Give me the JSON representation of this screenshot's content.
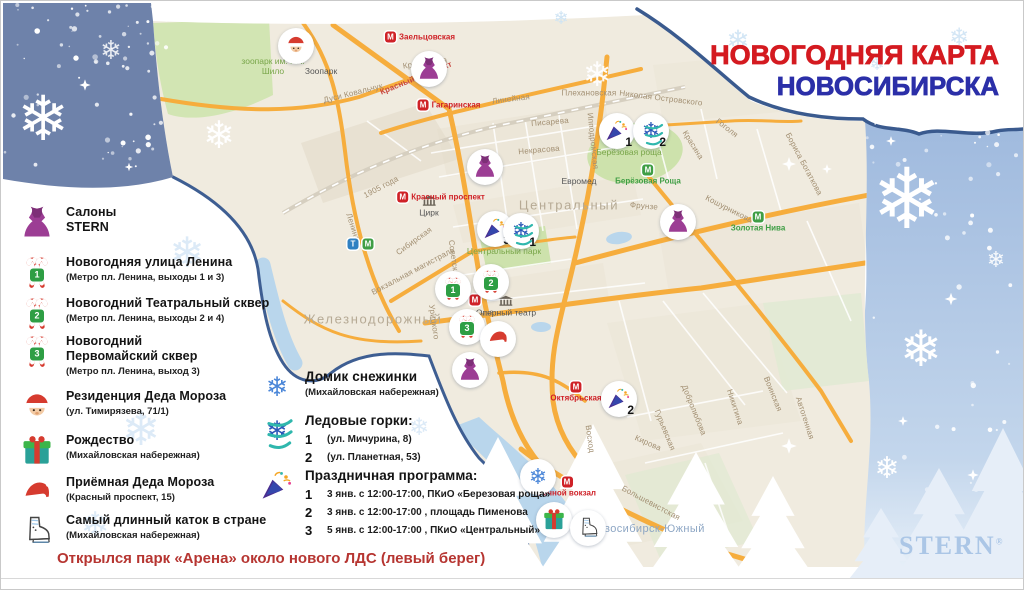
{
  "title": {
    "line1": "НОВОГОДНЯЯ КАРТА",
    "line2": "НОВОСИБИРСКА"
  },
  "brand": {
    "name": "STERN",
    "reg": "®"
  },
  "note": "Открылся парк «Арена» около нового ЛДС (левый берег)",
  "colors": {
    "title_red": "#d41a20",
    "title_blue": "#2b2fa8",
    "note_red": "#b63531",
    "brand_blue": "#abc6e6",
    "road_orange": "#f6ad3d",
    "water_blue": "#b9d6ec",
    "park_green": "#cde2ac",
    "panel_blue": "#9db8dd",
    "corner_slate": "#6e82aa",
    "boundary_navy": "#3e5e92",
    "metro_red": "#cf2127",
    "metro_green": "#3f9e45"
  },
  "legend": [
    {
      "icon": "dress-icon",
      "y": 204,
      "title": "Салоны\nSTERN"
    },
    {
      "icon": "candy-icon",
      "num": "1",
      "y": 254,
      "title": "Новогодняя улица Ленина",
      "sub": "(Метро пл. Ленина, выходы 1 и 3)"
    },
    {
      "icon": "candy-icon",
      "num": "2",
      "y": 295,
      "title": "Новогодний Театральный сквер",
      "sub": "(Метро пл. Ленина, выходы 2 и 4)"
    },
    {
      "icon": "candy-icon",
      "num": "3",
      "y": 333,
      "title": "Новогодний\nПервомайский сквер",
      "sub": "(Метро пл. Ленина, выход 3)"
    },
    {
      "icon": "santa-icon",
      "y": 388,
      "title": "Резиденция Деда Мороза",
      "sub": "(ул. Тимирязева, 71/1)"
    },
    {
      "icon": "gift-icon",
      "y": 432,
      "title": "Рождество",
      "sub": "(Михайловская набережная)"
    },
    {
      "icon": "hat-icon",
      "y": 474,
      "title": "Приёмная Деда Мороза",
      "sub": "(Красный проспект, 15)"
    },
    {
      "icon": "skate-icon",
      "y": 512,
      "title": "Самый длинный каток в стране",
      "sub": "(Михайловская набережная)"
    }
  ],
  "legend_mid": {
    "snow_house": {
      "icon": "flake-icon",
      "title": "Домик снежинки",
      "sub": "(Михайловская набережная)"
    },
    "slides": {
      "icon": "slide-icon",
      "title": "Ледовые горки:",
      "rows": [
        {
          "num": "1",
          "text": "(ул. Мичурина, 8)"
        },
        {
          "num": "2",
          "text": "(ул. Планетная, 53)"
        }
      ]
    },
    "program": {
      "icon": "popper-icon",
      "title": "Праздничная программа:",
      "rows": [
        {
          "num": "1",
          "text": "3 янв. с 12:00-17:00, ПКиО «Березовая роща»"
        },
        {
          "num": "2",
          "text": "3 янв. с 12:00-17:00 , площадь Пименова"
        },
        {
          "num": "3",
          "text": "5 янв. с 12:00-17:00 , ПКиО «Центральный»"
        }
      ]
    }
  },
  "map": {
    "districts": [
      {
        "label": "Центральный",
        "x": 568,
        "y": 204
      },
      {
        "label": "Железнодорожный",
        "x": 372,
        "y": 318
      },
      {
        "label": "Новосибирск-Южный",
        "x": 646,
        "y": 528,
        "cls": "blue"
      }
    ],
    "greens": [
      {
        "label": "Берёзовая роща",
        "x": 628,
        "y": 152
      },
      {
        "label": "Центральный парк",
        "x": 503,
        "y": 251
      },
      {
        "label": "зоопарк им. Р.А.\nШило",
        "x": 272,
        "y": 66
      }
    ],
    "pois": [
      {
        "label": "Зоопарк",
        "x": 320,
        "y": 70
      },
      {
        "label": "Цирк",
        "icon": "building-icon",
        "x": 428,
        "y": 205
      },
      {
        "label": "Оперный театр",
        "icon": "building-icon",
        "x": 505,
        "y": 305
      },
      {
        "label": "Евромед",
        "x": 578,
        "y": 180
      }
    ],
    "streets": [
      {
        "label": "Дуси Ковальчук",
        "x": 352,
        "y": 92,
        "rot": -14
      },
      {
        "label": "Кропоткина",
        "x": 424,
        "y": 62,
        "rot": -8
      },
      {
        "label": "Красный проспект",
        "x": 415,
        "y": 77,
        "rot": -22,
        "cls": "red"
      },
      {
        "label": "Линейная",
        "x": 510,
        "y": 98,
        "rot": -7
      },
      {
        "label": "Плехановская",
        "x": 588,
        "y": 92,
        "rot": 0
      },
      {
        "label": "Николая Островского",
        "x": 660,
        "y": 97,
        "rot": 7
      },
      {
        "label": "Писарева",
        "x": 549,
        "y": 121,
        "rot": -5
      },
      {
        "label": "Некрасова",
        "x": 538,
        "y": 149,
        "rot": -5
      },
      {
        "label": "Гоголя",
        "x": 726,
        "y": 127,
        "rot": 38
      },
      {
        "label": "Красина",
        "x": 692,
        "y": 144,
        "rot": 58
      },
      {
        "label": "Фрунзе",
        "x": 643,
        "y": 205,
        "rot": 5
      },
      {
        "label": "Фрунзе",
        "x": 479,
        "y": 313,
        "rot": -8
      },
      {
        "label": "Кошурникова",
        "x": 728,
        "y": 208,
        "rot": 27
      },
      {
        "label": "Бориса Богаткова",
        "x": 803,
        "y": 163,
        "rot": 62
      },
      {
        "label": "Ипподромская",
        "x": 592,
        "y": 140,
        "rot": 84
      },
      {
        "label": "Сибирская",
        "x": 413,
        "y": 240,
        "rot": -36
      },
      {
        "label": "Ленина",
        "x": 352,
        "y": 226,
        "rot": 72
      },
      {
        "label": "1905 года",
        "x": 380,
        "y": 186,
        "rot": -28
      },
      {
        "label": "Вокзальная магистраль",
        "x": 412,
        "y": 270,
        "rot": -28
      },
      {
        "label": "Советская",
        "x": 453,
        "y": 259,
        "rot": 82
      },
      {
        "label": "Урицкого",
        "x": 433,
        "y": 321,
        "rot": 82
      },
      {
        "label": "Восход",
        "x": 589,
        "y": 438,
        "rot": 82
      },
      {
        "label": "Кирова",
        "x": 647,
        "y": 442,
        "rot": 24
      },
      {
        "label": "Добролюбова",
        "x": 693,
        "y": 409,
        "rot": 68
      },
      {
        "label": "Никитина",
        "x": 734,
        "y": 406,
        "rot": 72
      },
      {
        "label": "Воинская",
        "x": 772,
        "y": 393,
        "rot": 68
      },
      {
        "label": "Автогенная",
        "x": 804,
        "y": 417,
        "rot": 72
      },
      {
        "label": "Большевистская",
        "x": 650,
        "y": 502,
        "rot": 28
      },
      {
        "label": "Гурьевская",
        "x": 664,
        "y": 429,
        "rot": 68
      }
    ],
    "stations": [
      {
        "letter": "М",
        "label": "Заельцовская",
        "x": 419,
        "y": 36,
        "color": "#cf2127"
      },
      {
        "letter": "М",
        "label": "Гагаринская",
        "x": 448,
        "y": 104,
        "color": "#cf2127"
      },
      {
        "letter": "М",
        "label": "Красный проспект",
        "x": 440,
        "y": 196,
        "color": "#cf2127"
      },
      {
        "letter": "М",
        "label": "",
        "x": 474,
        "y": 299,
        "color": "#cf2127"
      },
      {
        "letter": "М",
        "label": "Октябрьская",
        "x": 575,
        "y": 391,
        "color": "#cf2127",
        "cls": "below"
      },
      {
        "letter": "М",
        "label": "Речной вокзал",
        "x": 566,
        "y": 486,
        "color": "#cf2127",
        "cls": "below"
      },
      {
        "letter": "М",
        "label": "Берёзовая Роща",
        "x": 647,
        "y": 174,
        "color": "#3f9e45",
        "cls": "below"
      },
      {
        "letter": "М",
        "label": "Золотая Нива",
        "x": 757,
        "y": 221,
        "color": "#3f9e45",
        "cls": "below"
      },
      {
        "letter": "Т",
        "label": "",
        "x": 352,
        "y": 243,
        "color": "#2f80c2"
      },
      {
        "letter": "М",
        "label": "",
        "x": 367,
        "y": 243,
        "color": "#3f9e45"
      }
    ],
    "markers": [
      {
        "icon": "santa-icon",
        "x": 295,
        "y": 45
      },
      {
        "icon": "dress-icon",
        "x": 428,
        "y": 68
      },
      {
        "icon": "dress-icon",
        "x": 484,
        "y": 166
      },
      {
        "icon": "dress-icon",
        "x": 677,
        "y": 221
      },
      {
        "icon": "dress-icon",
        "x": 469,
        "y": 369
      },
      {
        "icon": "popper-icon",
        "x": 616,
        "y": 130,
        "num": "1"
      },
      {
        "icon": "slide-icon",
        "x": 650,
        "y": 130,
        "num": "2"
      },
      {
        "icon": "popper-icon",
        "x": 494,
        "y": 228,
        "num": "3"
      },
      {
        "icon": "slide-icon",
        "x": 520,
        "y": 230,
        "num": "1"
      },
      {
        "icon": "candy-icon",
        "x": 452,
        "y": 288,
        "num": "1",
        "cls": "candy"
      },
      {
        "icon": "candy-icon",
        "x": 490,
        "y": 281,
        "num": "2",
        "cls": "candy"
      },
      {
        "icon": "candy-icon",
        "x": 466,
        "y": 326,
        "num": "3",
        "cls": "candy"
      },
      {
        "icon": "hat-icon",
        "x": 497,
        "y": 338
      },
      {
        "icon": "popper-icon",
        "x": 618,
        "y": 398,
        "num": "2"
      },
      {
        "icon": "flake-icon",
        "x": 537,
        "y": 476
      },
      {
        "icon": "gift-icon",
        "x": 553,
        "y": 519
      },
      {
        "icon": "skate-icon",
        "x": 587,
        "y": 527
      }
    ]
  }
}
